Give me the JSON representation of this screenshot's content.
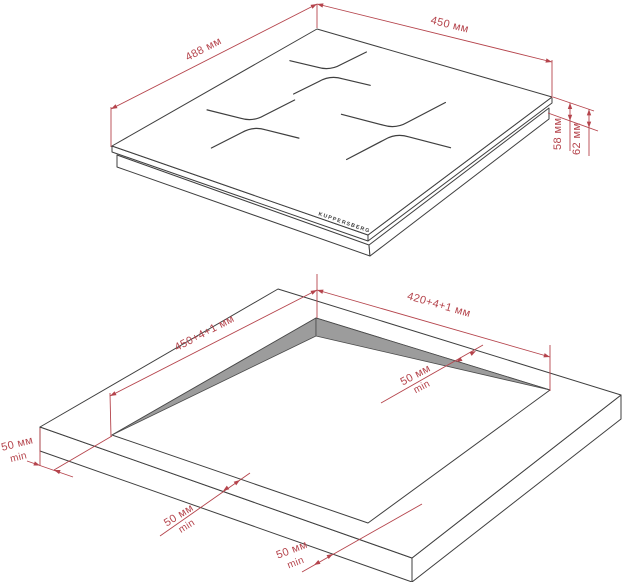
{
  "colors": {
    "dimension_red": "#b5444c",
    "outline_dark": "#3f3f3f",
    "cutout_wall_gray": "#9c9c9c",
    "background": "#ffffff"
  },
  "hob_view": {
    "brand": "KUPPERSBERG",
    "width": "488 мм",
    "depth": "450 мм",
    "height_body": "58 мм",
    "height_total": "62 мм",
    "burner_count": 3
  },
  "cutout_view": {
    "cutout_width": "450+4+1 мм",
    "cutout_depth": "420+4+1 мм",
    "clearances": {
      "left": {
        "value": "50 мм",
        "qualifier": "min"
      },
      "right": {
        "value": "50 мм",
        "qualifier": "min"
      },
      "front_left": {
        "value": "50 мм",
        "qualifier": "min"
      },
      "front": {
        "value": "50 мм",
        "qualifier": "min"
      }
    }
  }
}
